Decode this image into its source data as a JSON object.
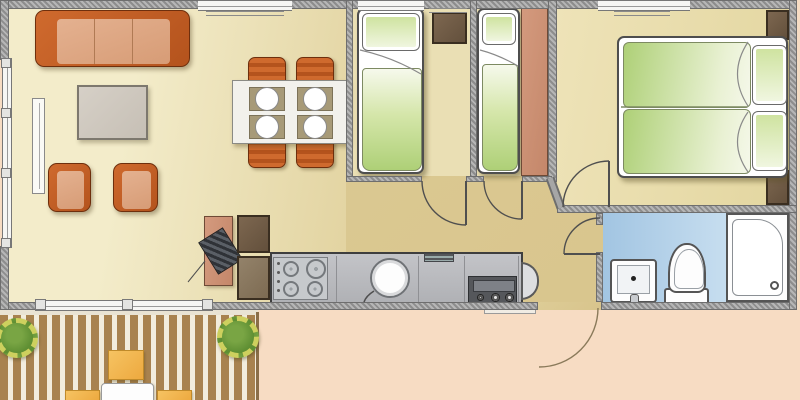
{
  "meta": {
    "title": "mobile-home-floor-plan",
    "canvas": {
      "width": 800,
      "height": 400
    },
    "visible_text": []
  },
  "palette": {
    "outside-peach": "#f7dcc3",
    "wall-gray": "#9e9e9e",
    "wall-dark": "#6e6e6e",
    "living-floor-light": "#f3ecca",
    "living-floor-dark": "#e2d3a0",
    "hall-floor": "#ddcc96",
    "bedroom-floor": "#eadfb4",
    "master-floor": "#e3d6a0",
    "bath-floor-light": "#d9eaf6",
    "bath-floor-dark": "#a2c5e2",
    "sofa-frame": "#b4531d",
    "sofa-cushion": "#d79c76",
    "chair-orange": "#b4531d",
    "table-gray": "#c6bfb5",
    "dining-table": "#f2f1ec",
    "placemat": "#a79a78",
    "bed-white": "#ffffff",
    "bed-green": "#aed077",
    "wardrobe-brown": "#63503c",
    "wardrobe-salmon": "#c4876a",
    "counter-gray": "#b0b1b5",
    "appliance-dark": "#55575b",
    "deck-wood": "#a8824f",
    "deck-gap": "#f2ecdc",
    "plant-green": "#5f8f33",
    "plant-ring": "#cdd05e",
    "deck-chair-yellow": "#eda93f",
    "line-dark": "#4f4f4f"
  },
  "rooms": [
    {
      "name": "living-dining-area"
    },
    {
      "name": "kitchen"
    },
    {
      "name": "twin-bedroom-1"
    },
    {
      "name": "twin-bedroom-2"
    },
    {
      "name": "master-bedroom"
    },
    {
      "name": "bathroom"
    },
    {
      "name": "hallway"
    },
    {
      "name": "deck-terrace"
    },
    {
      "name": "outside-ground"
    }
  ],
  "items": [
    "three-seat-sofa",
    "coffee-table",
    "armchair",
    "armchair",
    "radiator",
    "dining-table-four-settings",
    "dining-chair",
    "dining-chair",
    "dining-chair",
    "dining-chair",
    "tall-cabinet",
    "water-heater",
    "kitchen-cabinet",
    "kitchen-cabinet",
    "kitchen-counter",
    "four-burner-hob",
    "round-kitchen-sink",
    "oven",
    "counter-end-seat",
    "single-bed",
    "wardrobe",
    "single-bed",
    "tall-wardrobe",
    "double-bed",
    "pillow",
    "pillow",
    "nightstand",
    "nightstand",
    "bathroom-sink",
    "toilet",
    "shower-tray",
    "door-swing",
    "door-swing",
    "door-swing",
    "door-swing",
    "entrance-door-swing",
    "window",
    "window",
    "window",
    "window",
    "window",
    "planter-shrub",
    "planter-shrub",
    "deck-chair",
    "deck-chair",
    "deck-chair",
    "deck-table",
    "entry-step"
  ]
}
